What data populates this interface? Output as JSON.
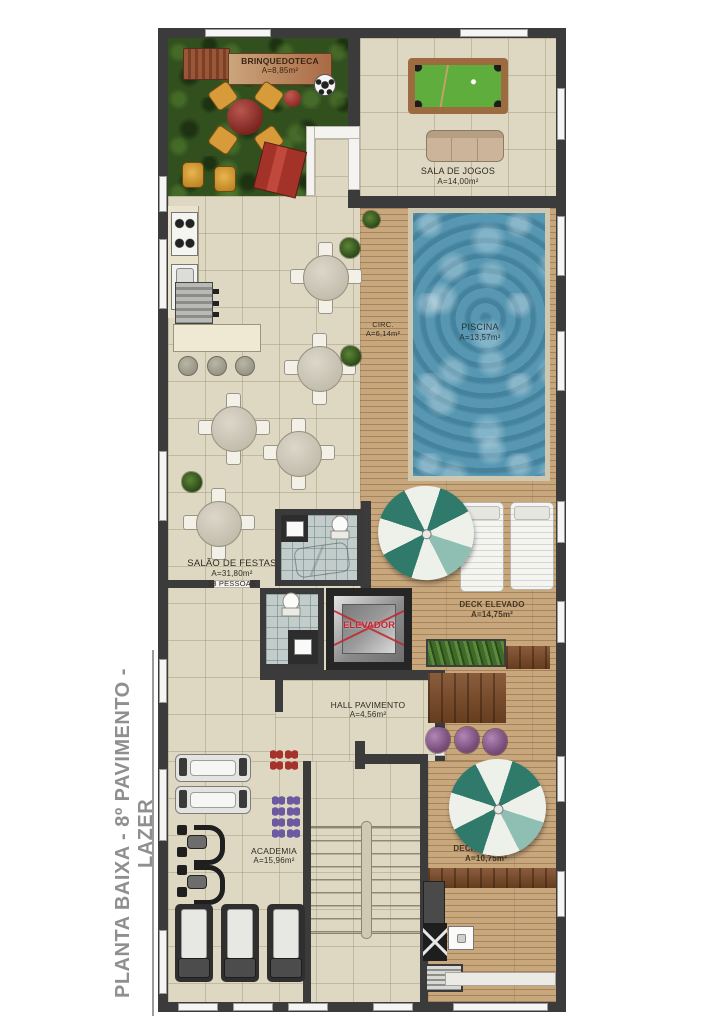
{
  "title": {
    "vertical_label": "PLANTA BAIXA - 8º PAVIMENTO - LAZER"
  },
  "rooms": {
    "brinquedoteca": {
      "name": "BRINQUEDOTECA",
      "area": "A=8,85m²"
    },
    "sala_de_jogos": {
      "name": "SALA DE JOGOS",
      "area": "A=14,00m²"
    },
    "circ": {
      "name": "CIRC.",
      "area": "A=6,14m²"
    },
    "piscina": {
      "name": "PISCINA",
      "area": "A=13,57m²"
    },
    "salao_de_festas": {
      "name": "SALÃO DE FESTAS",
      "area": "A=31,80m²",
      "capacity": "18 PESSOAS"
    },
    "elevador": {
      "name": "ELEVADOR"
    },
    "deck_elevado_1": {
      "name": "DECK ELEVADO",
      "area": "A=14,75m²"
    },
    "hall_pavimento": {
      "name": "HALL PAVIMENTO",
      "area": "A=4,56m²"
    },
    "academia": {
      "name": "ACADEMIA",
      "area": "A=15,96m²"
    },
    "deck_elevado_2": {
      "name": "DECK ELEVADO",
      "area": "A=10,75m²"
    }
  },
  "palette": {
    "wall": "#3b3b3b",
    "tile_floor": "#ded8c2",
    "wood_deck": "#c8a77d",
    "dark_wood": "#7c4a26",
    "grass": "#31501e",
    "pool_water": "#5797b2",
    "umbrella_teal": "#2f7a6a",
    "elevator_red": "#c0252e",
    "billiard_green": "#5fae3d",
    "title_gray": "#8f8f8f"
  }
}
